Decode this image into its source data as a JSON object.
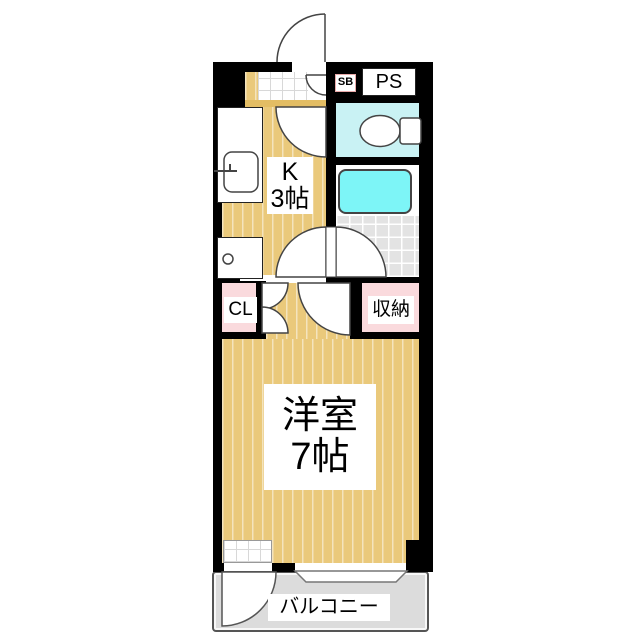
{
  "plan_title": "1K apartment floor plan",
  "labels": {
    "kitchen_line1": "K",
    "kitchen_line2": "3帖",
    "main_room_line1": "洋室",
    "main_room_line2": "7帖",
    "closet": "CL",
    "storage": "収納",
    "pipe_space": "PS",
    "shoe_box": "SB",
    "balcony": "バルコニー"
  },
  "colors": {
    "wall": "#000000",
    "flooring": "#eac97b",
    "closet_fill": "#fadadd",
    "toilet_room_fill": "#c9f2f4",
    "bathtub_fill": "#7df5f7",
    "bath_tile_fill": "#e3e3e3",
    "balcony_fill": "#dcdcdc",
    "shoe_box_border": "#e9a9a9"
  }
}
